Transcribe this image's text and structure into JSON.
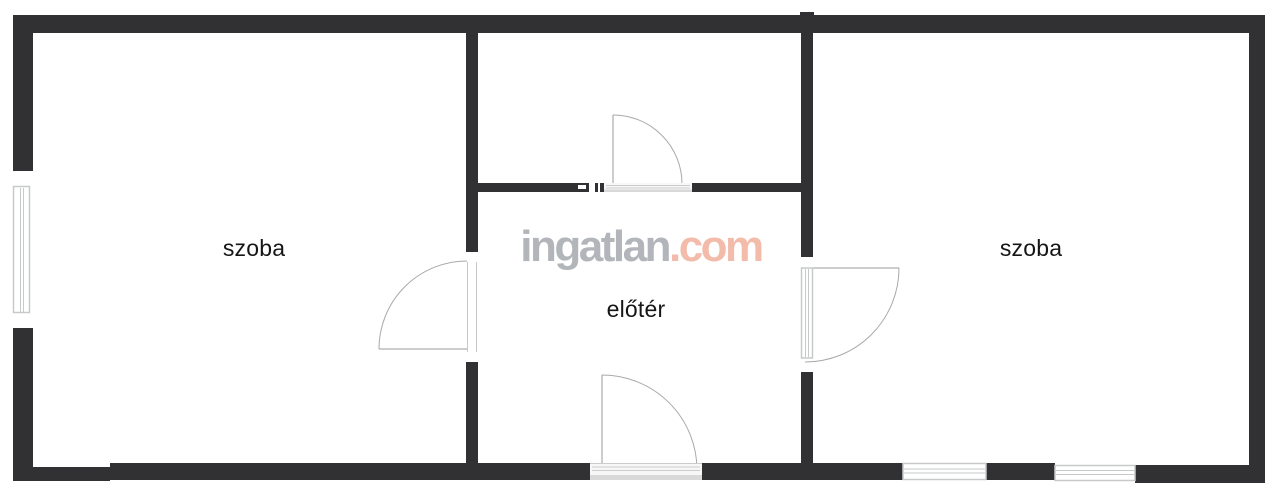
{
  "page": {
    "background": "#ffffff"
  },
  "rooms": [
    {
      "label": "szoba"
    },
    {
      "label": "előtér"
    },
    {
      "label": "szoba"
    }
  ],
  "watermark": {
    "word": "ingatlan",
    "tld": ".com"
  },
  "colors": {
    "wall": "#313134",
    "door_arc": "#a9a9a9",
    "door_leaf": "#9b9b9b",
    "window_frame": "#c7c9ca",
    "threshold_line": "#cccccc",
    "threshold_strip": "#d9d9d9",
    "label": "#161616",
    "wm_word": "#b2b6ba",
    "wm_tld": "#f2bbaa"
  }
}
